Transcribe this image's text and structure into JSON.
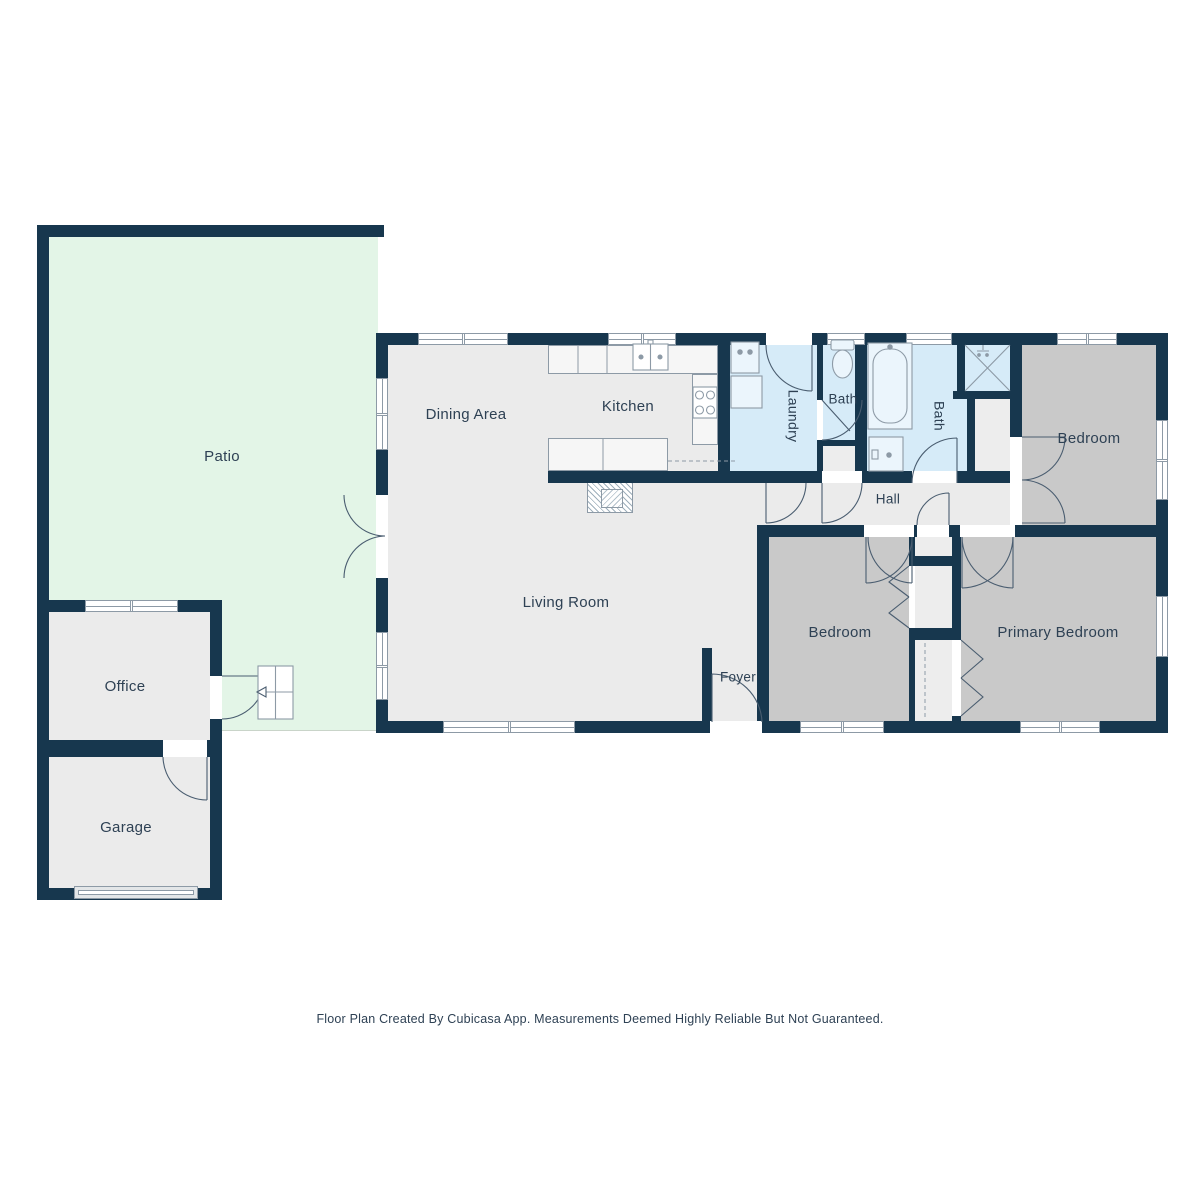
{
  "colors": {
    "wall": "#17374e",
    "patio": "#e3f5e7",
    "floor": "#ebebeb",
    "bedroom": "#c9c9c9",
    "bath": "#d6ebf8",
    "closet": "#ededed",
    "counter": "#f6f6f6",
    "bathfix": "#ebf5fc",
    "outline": "#8d9aa6",
    "arc": "#4a5d70",
    "text": "#2e4154",
    "garage_door": "#e3e6e8"
  },
  "rooms": {
    "patio": {
      "label": "Patio"
    },
    "dining_area": {
      "label": "Dining Area"
    },
    "kitchen": {
      "label": "Kitchen"
    },
    "living_room": {
      "label": "Living Room"
    },
    "foyer": {
      "label": "Foyer"
    },
    "hall": {
      "label": "Hall"
    },
    "laundry": {
      "label": "Laundry"
    },
    "bath_small": {
      "label": "Bath"
    },
    "bath_main": {
      "label": "Bath"
    },
    "bedroom_top_right": {
      "label": "Bedroom"
    },
    "bedroom_bottom": {
      "label": "Bedroom"
    },
    "primary_bedroom": {
      "label": "Primary Bedroom"
    },
    "office": {
      "label": "Office"
    },
    "garage": {
      "label": "Garage"
    }
  },
  "footer": {
    "disclaimer": "Floor Plan Created By Cubicasa App. Measurements Deemed Highly Reliable But Not Guaranteed."
  }
}
